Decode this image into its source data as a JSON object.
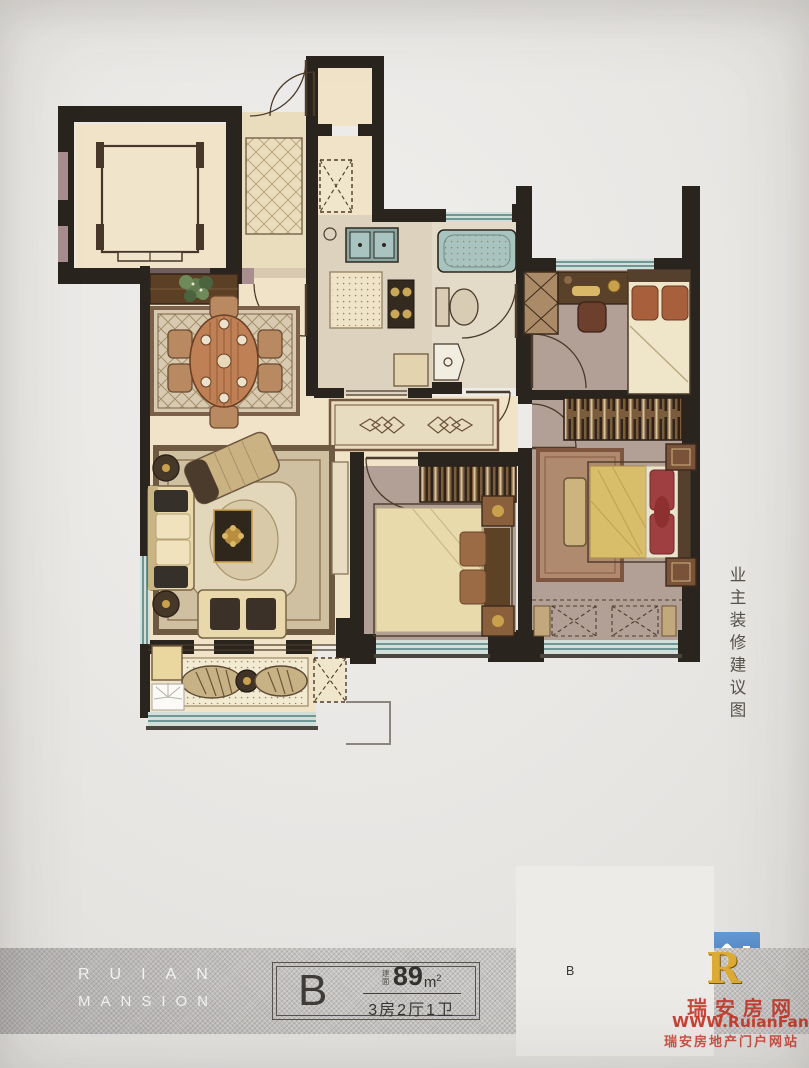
{
  "unit_card": {
    "unit_label": "B",
    "area_prefix": "建面",
    "area_value": "89",
    "area_unit_base": "m",
    "area_unit_exp": "2",
    "layout_text": "3房2厅1卫"
  },
  "brand": {
    "line1": "RUIAN",
    "line2": "MANSION"
  },
  "annotation": {
    "side_note": "业主装修建议图"
  },
  "key_plan": {
    "unit_label": "B"
  },
  "watermark": {
    "logo_letter": "R",
    "site_name": "瑞安房网",
    "site_url": "WWW.RuianFang.Com",
    "site_slogan": "瑞安房地产门户网站"
  },
  "palette": {
    "paper": "#e7e5e2",
    "band_gray": "#c6c4c2",
    "wall": "#2a241f",
    "wall_accent": "#a88e8e",
    "floor_cream": "#f0e3c7",
    "floor_tile": "#e9ddbd",
    "floor_warm": "#ddd2bd",
    "floor_bath": "#e3dac8",
    "floor_bedroom": "#b2a096",
    "window_teal": "#5f8e8c",
    "window_glass": "#d3ded9",
    "wood_dark": "#5c4026",
    "gold": "#d9a62e",
    "brand_red": "#c12c1f",
    "logo_blue": "#2f6db5",
    "text_dark": "#3a3835"
  }
}
